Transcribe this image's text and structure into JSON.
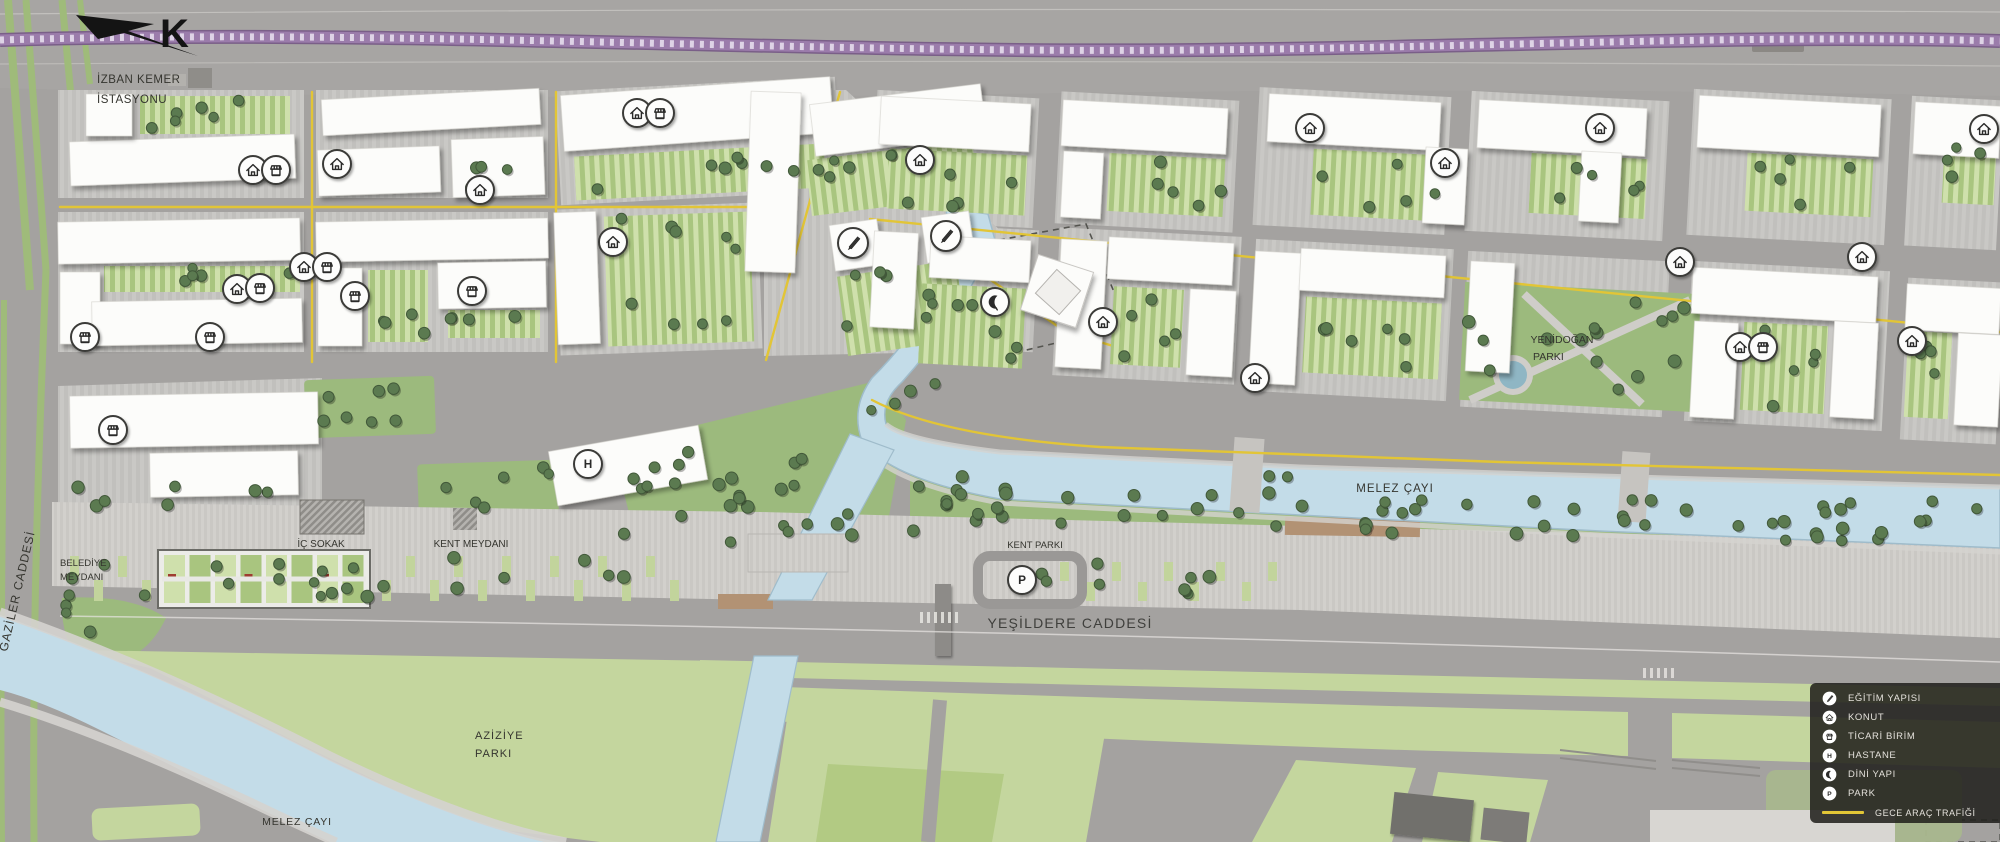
{
  "colors": {
    "road": "#a4a2a0",
    "block": "#c9c8c5",
    "building": "#fcfcfa",
    "water": "#c3dce8",
    "park_green": "#9cba7d",
    "light_green": "#c4d69e",
    "court_green": "#b7cc8b",
    "tree": "#5b7a50",
    "railway_purple": "#9677a6",
    "night_traffic_yellow": "#e2c536",
    "legend_bg": "rgba(33,32,29,0.87)",
    "legend_text": "#e4e1db"
  },
  "north_label": "K",
  "station": {
    "line1": "İZBAN KEMER",
    "line2": "İSTASYONU"
  },
  "labels": {
    "gaziler": "GAZİLER CADDESİ",
    "belediye1": "BELEDİYE",
    "belediye2": "MEYDANI",
    "ic_sokak": "İÇ SOKAK",
    "kent_meydani": "KENT MEYDANI",
    "kent_parki": "KENT PARKI",
    "melez_upper": "MELEZ ÇAYI",
    "yenidogan1": "YENİDOĞAN",
    "yenidogan2": "PARKI",
    "yesildere": "YEŞİLDERE CADDESİ",
    "aziziye1": "AZİZİYE",
    "aziziye2": "PARKI",
    "melez_lower": "MELEZ ÇAYI"
  },
  "legend": {
    "items": [
      {
        "icon": "egitim",
        "label": "EĞİTİM YAPISI"
      },
      {
        "icon": "konut",
        "label": "KONUT"
      },
      {
        "icon": "ticari",
        "label": "TİCARİ BİRİM"
      },
      {
        "icon": "hastane",
        "label": "HASTANE"
      },
      {
        "icon": "dini",
        "label": "DİNİ YAPI"
      },
      {
        "icon": "park",
        "label": "PARK"
      }
    ],
    "night_traffic_label": "GECE ARAÇ TRAFİĞİ"
  },
  "map_icons": [
    {
      "type": "konut",
      "x": 253,
      "y": 170
    },
    {
      "type": "ticari",
      "x": 276,
      "y": 170
    },
    {
      "type": "konut",
      "x": 337,
      "y": 164
    },
    {
      "type": "konut",
      "x": 480,
      "y": 190
    },
    {
      "type": "konut",
      "x": 637,
      "y": 113
    },
    {
      "type": "ticari",
      "x": 660,
      "y": 113
    },
    {
      "type": "konut",
      "x": 304,
      "y": 267
    },
    {
      "type": "ticari",
      "x": 327,
      "y": 267
    },
    {
      "type": "konut",
      "x": 237,
      "y": 289
    },
    {
      "type": "ticari",
      "x": 260,
      "y": 288
    },
    {
      "type": "ticari",
      "x": 355,
      "y": 296
    },
    {
      "type": "ticari",
      "x": 472,
      "y": 291
    },
    {
      "type": "ticari",
      "x": 85,
      "y": 337
    },
    {
      "type": "ticari",
      "x": 210,
      "y": 337
    },
    {
      "type": "konut",
      "x": 613,
      "y": 242
    },
    {
      "type": "egitim",
      "x": 853,
      "y": 243
    },
    {
      "type": "egitim",
      "x": 946,
      "y": 236
    },
    {
      "type": "dini",
      "x": 995,
      "y": 302
    },
    {
      "type": "konut",
      "x": 1103,
      "y": 322
    },
    {
      "type": "konut",
      "x": 1255,
      "y": 378
    },
    {
      "type": "konut",
      "x": 920,
      "y": 160
    },
    {
      "type": "konut",
      "x": 1310,
      "y": 128
    },
    {
      "type": "konut",
      "x": 1445,
      "y": 163
    },
    {
      "type": "konut",
      "x": 1600,
      "y": 128
    },
    {
      "type": "konut",
      "x": 1984,
      "y": 129
    },
    {
      "type": "konut",
      "x": 1680,
      "y": 262
    },
    {
      "type": "konut",
      "x": 1862,
      "y": 257
    },
    {
      "type": "konut",
      "x": 1740,
      "y": 347
    },
    {
      "type": "ticari",
      "x": 1763,
      "y": 347
    },
    {
      "type": "konut",
      "x": 1912,
      "y": 341
    },
    {
      "type": "ticari",
      "x": 113,
      "y": 430
    },
    {
      "type": "hastane",
      "x": 588,
      "y": 464
    },
    {
      "type": "park",
      "x": 1022,
      "y": 580
    }
  ]
}
